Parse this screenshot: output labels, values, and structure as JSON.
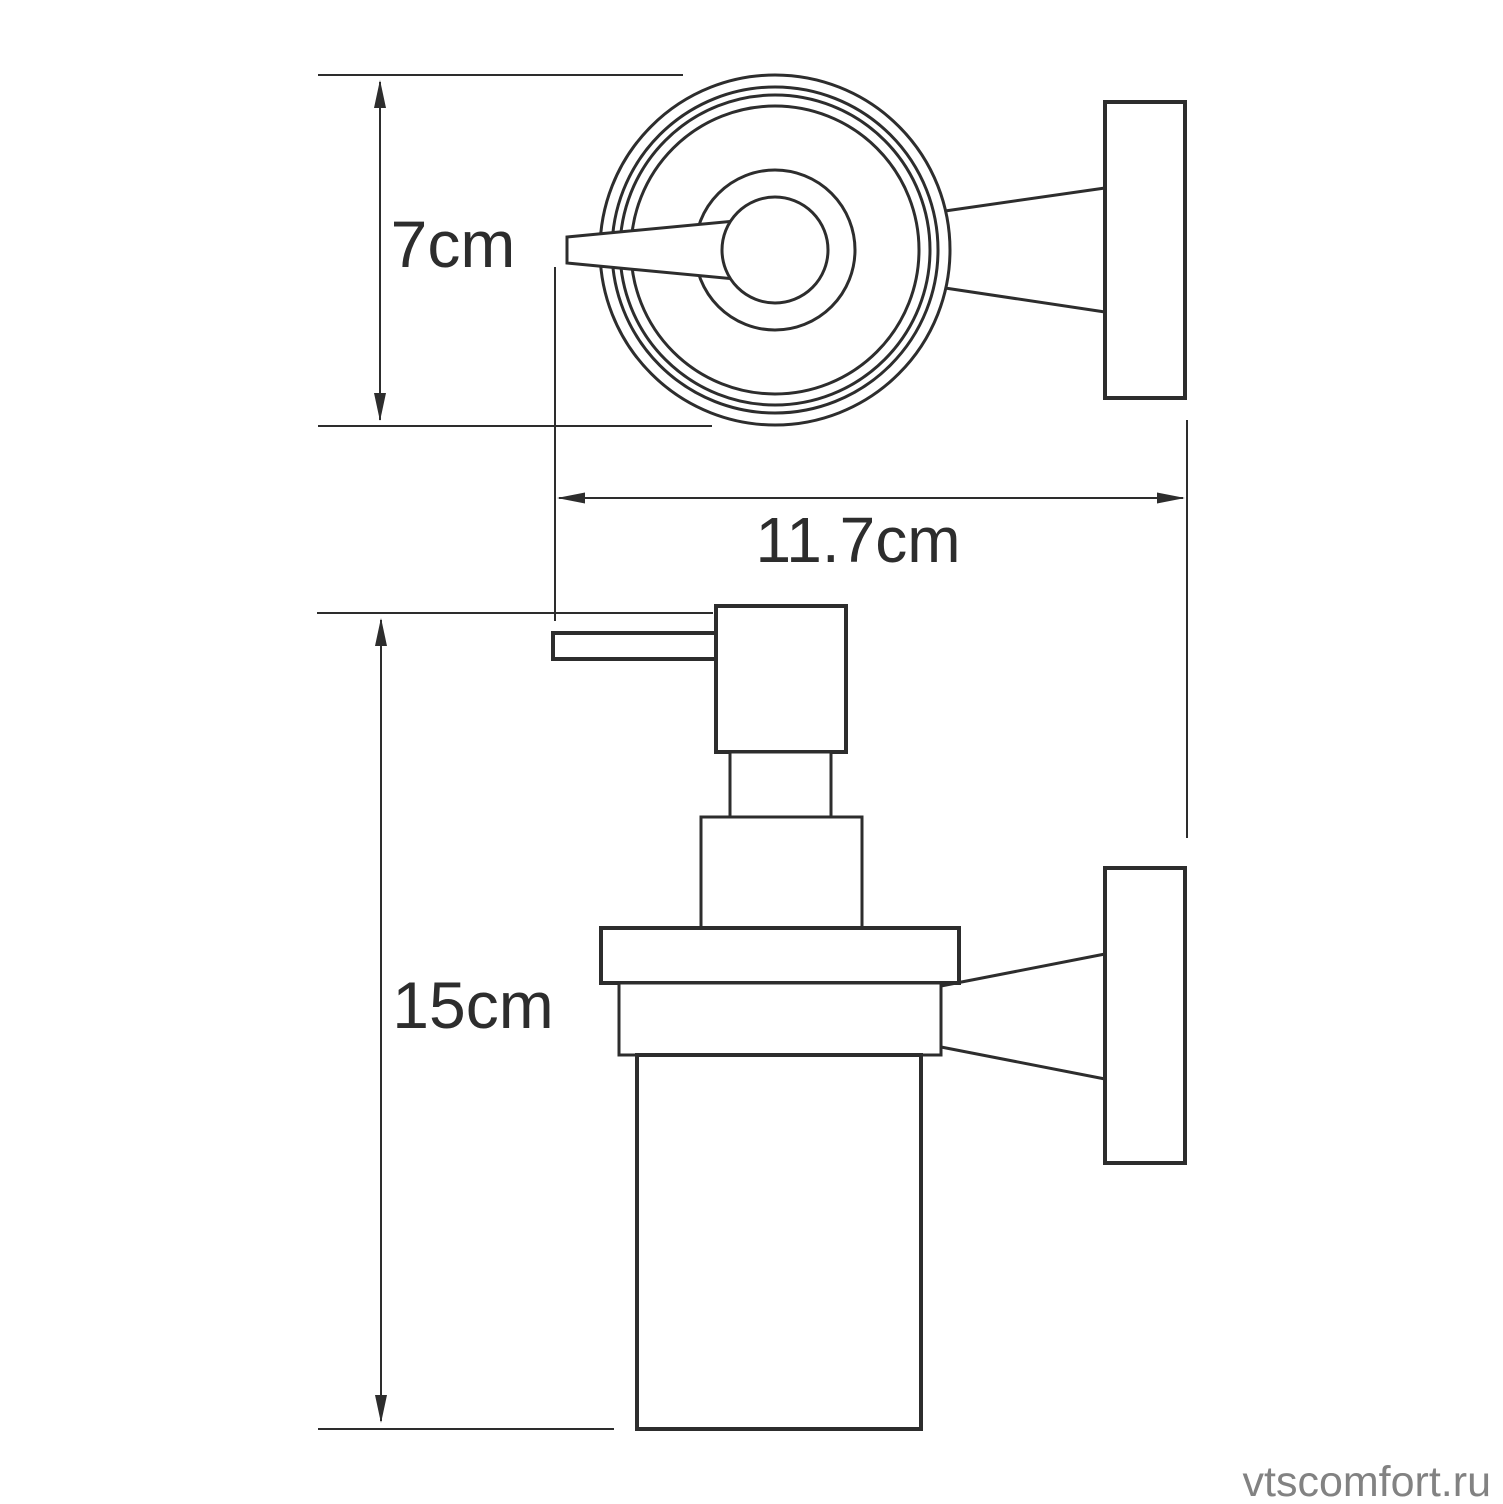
{
  "drawing": {
    "type": "technical-drawing",
    "subject": "wall-mounted soap dispenser, top view and side view",
    "labels": {
      "diameter": "7cm",
      "depth": "11.7cm",
      "height": "15cm"
    },
    "watermark": "vtscomfort.ru",
    "colors": {
      "line": "#2d2d2d",
      "watermark": "#828282",
      "background": "#ffffff"
    }
  }
}
